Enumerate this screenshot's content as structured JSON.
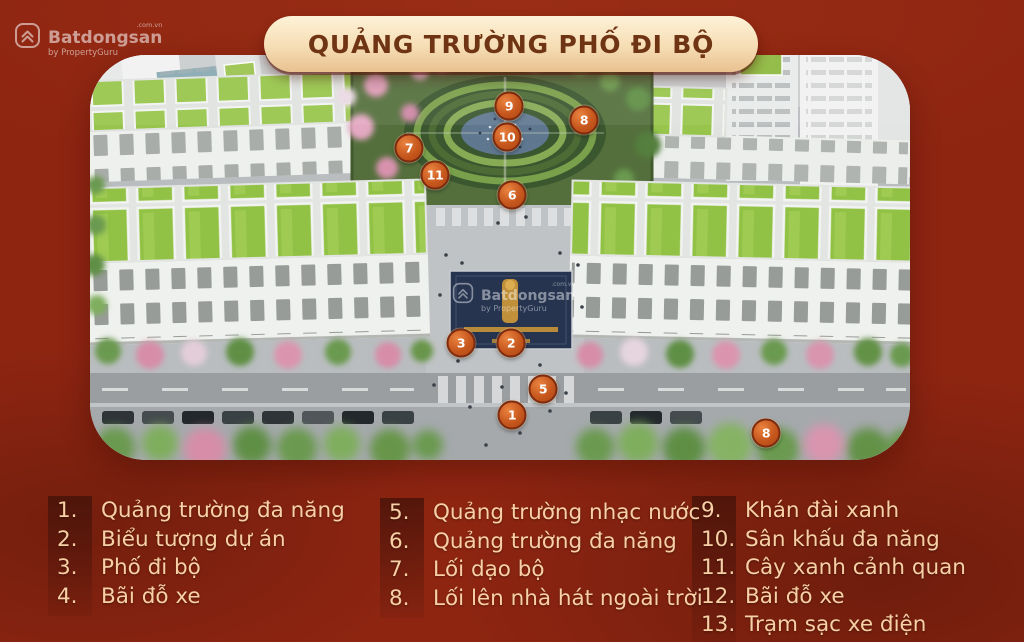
{
  "banner": {
    "title": "QUẢNG TRƯỜNG PHỐ ĐI BỘ"
  },
  "watermark": {
    "brand": "Batdongsan",
    "domain": ".com.vn",
    "byline": "by PropertyGuru"
  },
  "colors": {
    "background_red": "#8e2511",
    "banner_cream": "#f6ddb4",
    "banner_text": "#6f3413",
    "legend_text": "#f7d0a6",
    "marker_orange": "#c6571d",
    "marker_border": "#7e2b10",
    "roof_green": "#92c245",
    "plaza_navy": "#263450",
    "emblem_gold": "#c0903a"
  },
  "markers": [
    {
      "num": "9",
      "x": 419,
      "y": 51
    },
    {
      "num": "8",
      "x": 494,
      "y": 65
    },
    {
      "num": "10",
      "x": 417,
      "y": 82
    },
    {
      "num": "7",
      "x": 319,
      "y": 93
    },
    {
      "num": "11",
      "x": 345,
      "y": 120
    },
    {
      "num": "6",
      "x": 422,
      "y": 140
    },
    {
      "num": "3",
      "x": 371,
      "y": 288
    },
    {
      "num": "2",
      "x": 421,
      "y": 288
    },
    {
      "num": "5",
      "x": 453,
      "y": 334
    },
    {
      "num": "1",
      "x": 422,
      "y": 360
    },
    {
      "num": "8",
      "x": 676,
      "y": 378
    }
  ],
  "legend": {
    "columns": [
      {
        "items": [
          {
            "num": "1.",
            "label": "Quảng trường đa năng"
          },
          {
            "num": "2.",
            "label": "Biểu tượng dự án"
          },
          {
            "num": "3.",
            "label": "Phố đi bộ"
          },
          {
            "num": "4.",
            "label": "Bãi đỗ xe"
          }
        ]
      },
      {
        "items": [
          {
            "num": "5.",
            "label": "Quảng trường nhạc nước"
          },
          {
            "num": "6.",
            "label": "Quảng trường đa năng"
          },
          {
            "num": "7.",
            "label": "Lối dạo bộ"
          },
          {
            "num": "8.",
            "label": "Lối lên nhà hát ngoài trời"
          }
        ]
      },
      {
        "items": [
          {
            "num": "9.",
            "label": "Khán đài xanh"
          },
          {
            "num": "10.",
            "label": "Sân khấu đa năng"
          },
          {
            "num": "11.",
            "label": "Cây xanh cảnh quan"
          },
          {
            "num": "12.",
            "label": "Bãi đỗ xe"
          },
          {
            "num": "13.",
            "label": "Trạm sạc xe điện"
          }
        ]
      }
    ]
  }
}
